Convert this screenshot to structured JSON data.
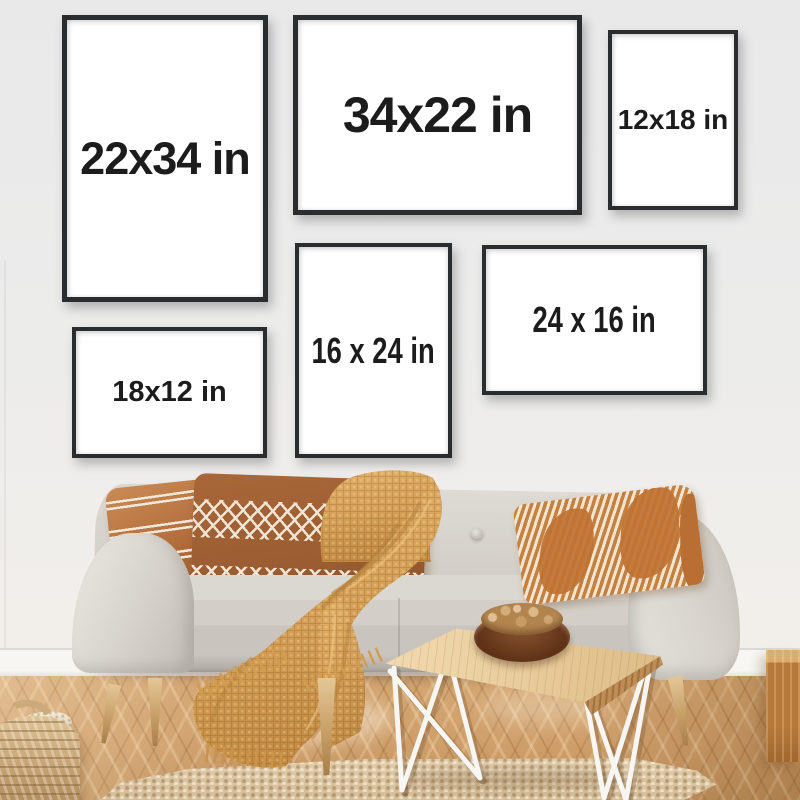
{
  "scene_title": "Frame size guide photo — living room wall gallery above sofa",
  "frames": [
    {
      "id": "22x34",
      "label": "22x34 in",
      "orientation": "portrait"
    },
    {
      "id": "34x22",
      "label": "34x22 in",
      "orientation": "landscape"
    },
    {
      "id": "12x18",
      "label": "12x18 in",
      "orientation": "portrait"
    },
    {
      "id": "16x24",
      "label": "16 x 24 in",
      "orientation": "portrait"
    },
    {
      "id": "24x16",
      "label": "24 x 16 in",
      "orientation": "landscape"
    },
    {
      "id": "18x12",
      "label": "18x12 in",
      "orientation": "landscape"
    }
  ],
  "colors": {
    "frame_border": "#2b2c2e",
    "label_text": "#1c1c1c",
    "wall": "#ececeb",
    "sofa_fabric": "#d6d2cb",
    "blanket": "#d9a55e",
    "pillow_rust": "#b06a3a",
    "floor_wood": "#cf9f6b",
    "rug": "#dcc7a5"
  }
}
